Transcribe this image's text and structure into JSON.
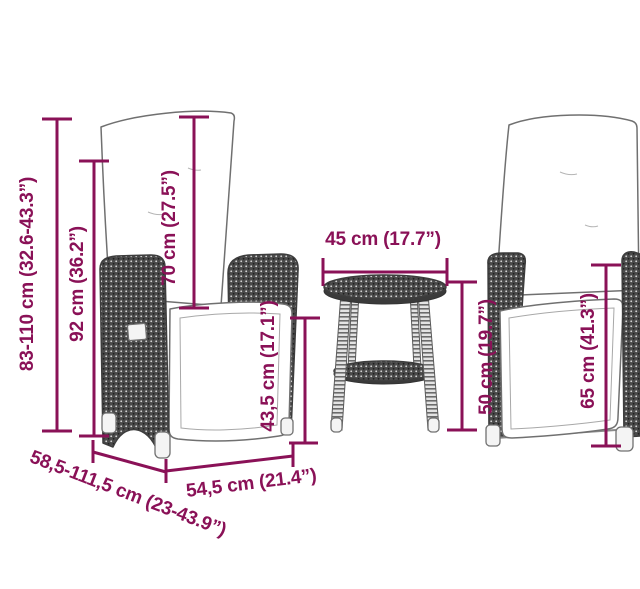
{
  "colors": {
    "accent": "#8a1157",
    "background": "#ffffff",
    "outline": "#707070",
    "wicker": "#4a4a4a",
    "wicker_dot_light": "#d9d9d9",
    "wicker_dot_dark": "#1f1f1f",
    "cushion": "#ffffff",
    "leg_base": "#e3e3e3",
    "leg_band": "#6b6b6b",
    "foot": "#f4f4f4"
  },
  "dims": {
    "chair_height": {
      "label": "83-110 cm (32.6-43.3”)"
    },
    "backrest_top_height": {
      "label": "92 cm (36.2”)"
    },
    "backrest_length": {
      "label": "70 cm (27.5”)"
    },
    "seat_height": {
      "label": "43,5 cm (17.1”)"
    },
    "table_diameter": {
      "label": "45 cm (17.7”)"
    },
    "table_height": {
      "label": "50 cm (19.7”)"
    },
    "armrest_height": {
      "label": "65 cm (41.3”)"
    },
    "seat_width": {
      "label": "54,5 cm (21.4”)"
    },
    "chair_depth": {
      "label": "58,5-111,5 cm (23-43.9”)"
    }
  }
}
